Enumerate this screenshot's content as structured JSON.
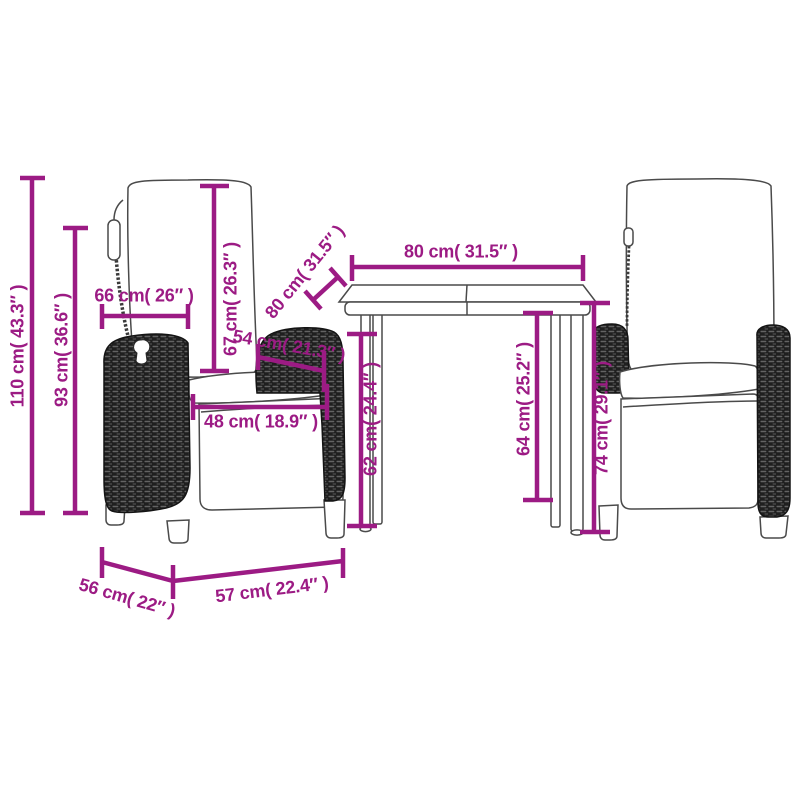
{
  "colors": {
    "dimension_accent": "#9C1B84",
    "line_art": "#4A4A4A",
    "wicker_dark": "#1F1F1F",
    "background": "#FFFFFF"
  },
  "dimensions": {
    "h110": {
      "label": "110 cm( 43.3″ )",
      "cm": 110,
      "inches": 43.3
    },
    "h93": {
      "label": "93 cm( 36.6″ )",
      "cm": 93,
      "inches": 36.6
    },
    "w66": {
      "label": "66 cm( 26″ )",
      "cm": 66,
      "inches": 26
    },
    "h67": {
      "label": "67 cm( 26.3″ )",
      "cm": 67,
      "inches": 26.3
    },
    "d80": {
      "label": "80 cm( 31.5″ )",
      "cm": 80,
      "inches": 31.5
    },
    "w80": {
      "label": "80 cm( 31.5″ )",
      "cm": 80,
      "inches": 31.5
    },
    "d54": {
      "label": "54 cm( 21.3″ )",
      "cm": 54,
      "inches": 21.3
    },
    "w48": {
      "label": "48 cm( 18.9″ )",
      "cm": 48,
      "inches": 18.9
    },
    "h62": {
      "label": "62 cm( 24.4″ )",
      "cm": 62,
      "inches": 24.4
    },
    "h64": {
      "label": "64 cm( 25.2″ )",
      "cm": 64,
      "inches": 25.2
    },
    "h74": {
      "label": "74 cm( 29.1″ )",
      "cm": 74,
      "inches": 29.1
    },
    "d56": {
      "label": "56 cm( 22″ )",
      "cm": 56,
      "inches": 22
    },
    "w57": {
      "label": "57 cm( 22.4″ )",
      "cm": 57,
      "inches": 22.4
    }
  }
}
